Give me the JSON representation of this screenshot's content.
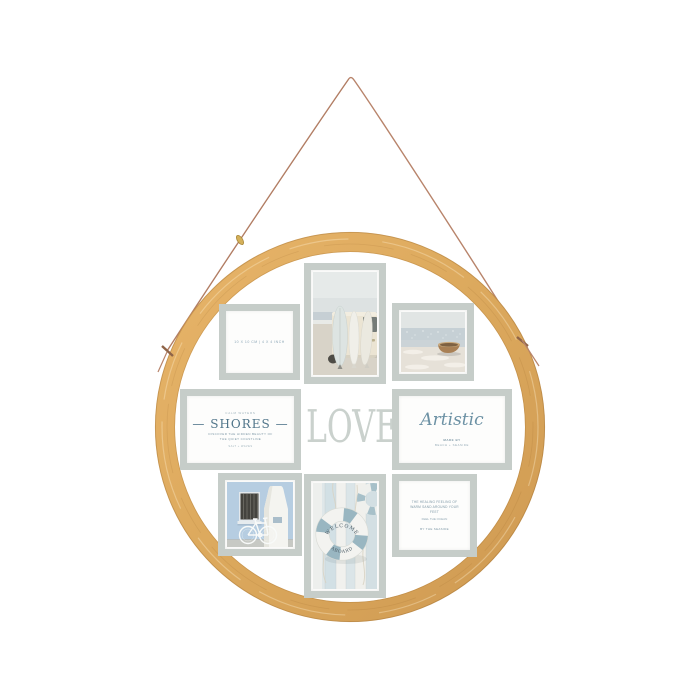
{
  "center": {
    "love_label": "LOVE"
  },
  "inserts": {
    "size_label": {
      "text": "10 X 10 CM  |  4 X 4 INCH"
    },
    "shores": {
      "kicker": "CALM WATERS",
      "title": "—  SHORES  —",
      "line1": "DISCOVER THE HIDDEN BEAUTY OF",
      "line2": "THE QUIET COASTLINE",
      "footer": "SALT + WAVES"
    },
    "artistic": {
      "title": "Artistic",
      "line1": "MADE BY",
      "line2": "BEACH  +  SEASIDE"
    },
    "quote": {
      "line1": "THE HEALING FEELING OF WARM SAND AROUND YOUR FEET",
      "line2": "FEEL THE OCEAN",
      "line3": "BY THE SEASIDE"
    }
  },
  "lifebuoy": {
    "top_text": "WELCOME",
    "bottom_text": "ABOARD"
  },
  "photos": {
    "top_center": "surfboards leaning on camper van at beach",
    "top_right": "rowing boat on sandy shore",
    "bottom_left": "white bicycle against pale blue wall and chimney",
    "bottom_center": "welcome-aboard lifebuoy on striped planks"
  },
  "colors": {
    "background": "#ffffff",
    "bamboo_light": "#e7b469",
    "bamboo_dark": "#cf9a52",
    "frame_border": "#c6cdc9",
    "mat_white": "#fdfdfc",
    "love_text": "#cad1cd",
    "accent_blue": "#4f7489",
    "photo_blue": "#99b6c1",
    "cord_brown": "#b8846b",
    "clasp_gold": "#d4b05a"
  }
}
